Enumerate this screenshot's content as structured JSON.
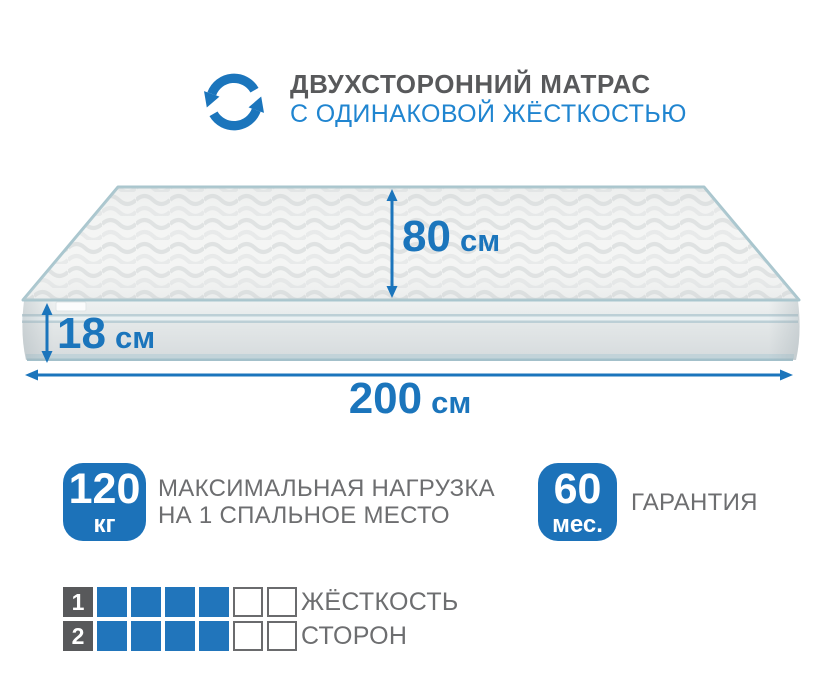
{
  "palette": {
    "accent_blue": "#1b75bc",
    "subtitle_blue": "#2085d0",
    "badge_blue": "#1c72b9",
    "square_blue": "#2175bb",
    "title_gray": "#58595b",
    "text_gray": "#6d6e70",
    "edge_teal": "#a9c6ce",
    "square_border_gray": "#6a6b6d"
  },
  "header": {
    "icon": "rotate-arrows-icon",
    "title": "ДВУХСТОРОННИЙ МАТРАС",
    "subtitle": "С ОДИНАКОВОЙ ЖЁСТКОСТЬЮ"
  },
  "dimensions": {
    "top_width": {
      "value": "80",
      "unit": "см"
    },
    "side_height": {
      "value": "18",
      "unit": "см"
    },
    "length": {
      "value": "200",
      "unit": "см"
    }
  },
  "features": {
    "max_load": {
      "value": "120",
      "unit": "кг",
      "line1": "МАКСИМАЛЬНАЯ НАГРУЗКА",
      "line2": "НА 1 СПАЛЬНОЕ МЕСТО"
    },
    "warranty": {
      "value": "60",
      "unit": "мес.",
      "label": "ГАРАНТИЯ"
    }
  },
  "firmness": {
    "rows": [
      {
        "number": "1",
        "filled": 4,
        "total": 6
      },
      {
        "number": "2",
        "filled": 4,
        "total": 6
      }
    ],
    "label_line1": "ЖЁСТКОСТЬ",
    "label_line2": "СТОРОН"
  }
}
